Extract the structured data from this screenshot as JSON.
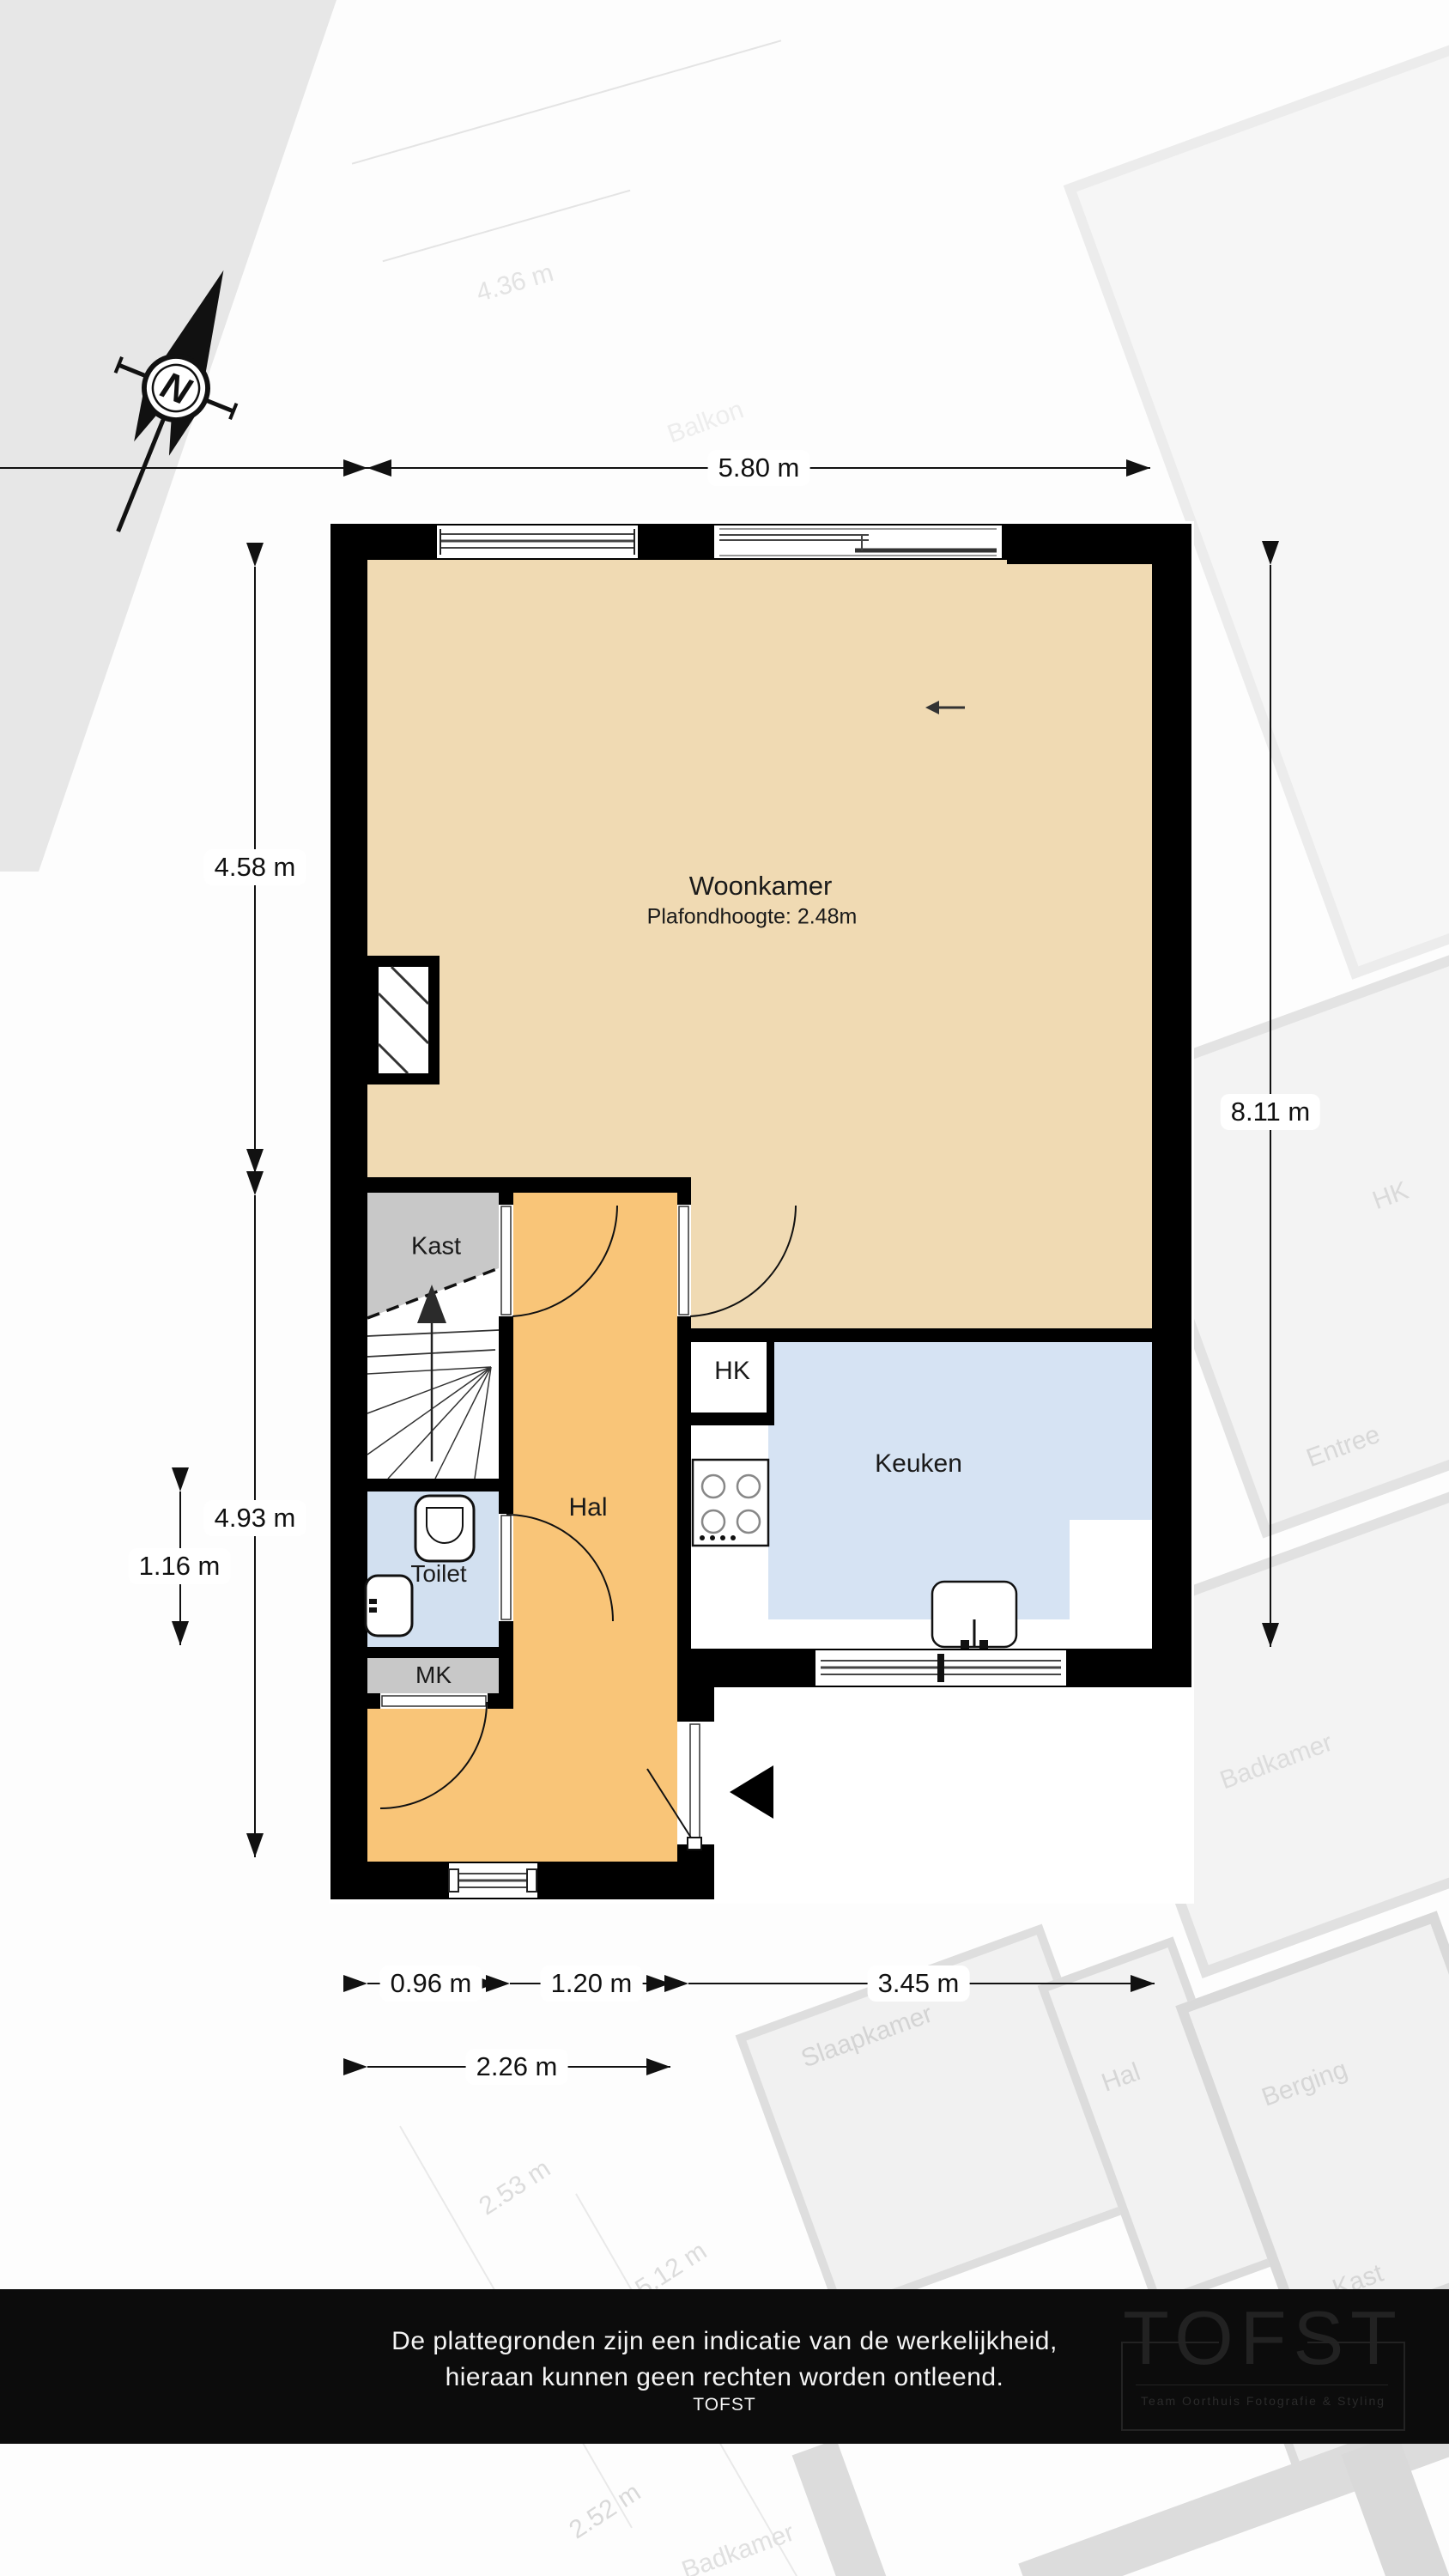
{
  "plan": {
    "rooms": {
      "woonkamer": {
        "label": "Woonkamer",
        "sub": "Plafondhoogte: 2.48m"
      },
      "keuken": {
        "label": "Keuken"
      },
      "hal": {
        "label": "Hal"
      },
      "kast": {
        "label": "Kast"
      },
      "toilet": {
        "label": "Toilet"
      },
      "mk": {
        "label": "MK"
      },
      "hk": {
        "label": "HK"
      }
    },
    "dimensions": {
      "top": "5.80 m",
      "left_upper": "4.58 m",
      "left_lower": "4.93 m",
      "left_inner": "1.16 m",
      "right": "8.11 m",
      "bottom_row": [
        "0.96 m",
        "1.20 m",
        "3.45 m"
      ],
      "bottom_row2": "2.26 m"
    },
    "compass": {
      "label": "N"
    }
  },
  "footer": {
    "line1": "De plattegronden zijn een indicatie van de werkelijkheid,",
    "line2": "hieraan kunnen geen rechten worden ontleend.",
    "line3": "TOFST"
  },
  "logo": {
    "title": "TOFST",
    "subtitle": "Team Oorthuis Fotografie & Styling"
  },
  "background": {
    "labels": [
      {
        "text": "4.36 m"
      },
      {
        "text": "Balkon"
      },
      {
        "text": "HK"
      },
      {
        "text": "Entree"
      },
      {
        "text": "Badkamer"
      },
      {
        "text": "Slaapkamer"
      },
      {
        "text": "Hal"
      },
      {
        "text": "Berging"
      },
      {
        "text": "Kast"
      },
      {
        "text": "2.53 m"
      },
      {
        "text": "5.12 m"
      },
      {
        "text": "2.52 m"
      },
      {
        "text": "Badkamer"
      }
    ]
  },
  "colors": {
    "wall": "#000000",
    "woonkamer": "#f0dab3",
    "hal": "#f9c578",
    "keuken": "#d6e3f3",
    "toilet": "#d2e0f0",
    "kast": "#c8c8c8",
    "footer": "#0c0c0c"
  }
}
